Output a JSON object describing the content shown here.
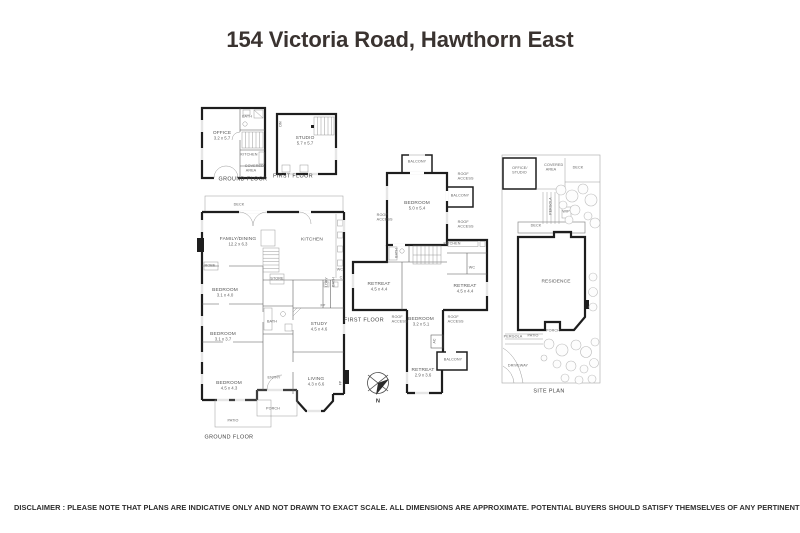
{
  "title": "154 Victoria Road, Hawthorn East",
  "disclaimer": "DISCLAIMER : PLEASE NOTE THAT PLANS ARE INDICATIVE ONLY AND NOT DRAWN TO EXACT SCALE. ALL DIMENSIONS ARE APPROXIMATE. POTENTIAL BUYERS SHOULD SATISFY THEMSELVES OF ANY PERTINENT MATTERS.",
  "compass": {
    "north_label": "N"
  },
  "plans": {
    "outbuilding_ground": {
      "floor_label": "GROUND FLOOR",
      "office": {
        "name": "OFFICE",
        "dims": "3.2 x 5.7"
      },
      "bath": "BATH",
      "kitchen": "KITCHEN",
      "covered_area": "COVERED AREA"
    },
    "outbuilding_first": {
      "floor_label": "FIRST FLOOR",
      "studio": {
        "name": "STUDIO",
        "dims": "5.7 x 5.7"
      },
      "dn": "DN"
    },
    "ground_floor": {
      "floor_label": "GROUND FLOOR",
      "deck": "DECK",
      "family_dining": {
        "name": "FAMILY/DINING",
        "dims": "12.2 x 6.3"
      },
      "kitchen": "KITCHEN",
      "bedroom1": {
        "name": "BEDROOM",
        "dims": "3.1 x 4.0"
      },
      "robe": "ROBE",
      "store": "STORE",
      "bath": "BATH",
      "study": {
        "name": "STUDY",
        "dims": "4.5 x 4.6"
      },
      "bedroom2": {
        "name": "BEDROOM",
        "dims": "3.1 x 3.7"
      },
      "bedroom3": {
        "name": "BEDROOM",
        "dims": "4.5 x 4.3"
      },
      "entry": "ENTRY",
      "living": {
        "name": "LIVING",
        "dims": "4.3 x 6.6"
      },
      "porch": "PORCH",
      "patio": "PATIO",
      "ldry": "LDRY",
      "bath2": "BATH",
      "wc": "WC",
      "cupboard": "C",
      "fp": "FP"
    },
    "first_floor": {
      "floor_label": "FIRST FLOOR",
      "balcony": "BALCONY",
      "roof_access": "ROOF ACCESS",
      "bedroom1": {
        "name": "BEDROOM",
        "dims": "5.0 x 5.4"
      },
      "kitchen": "KITCHEN",
      "bath": "BATH",
      "retreat1": {
        "name": "RETREAT",
        "dims": "4.5 x 4.4"
      },
      "retreat2": {
        "name": "RETREAT",
        "dims": "4.5 x 4.4"
      },
      "bedroom2": {
        "name": "BEDROOM",
        "dims": "3.2 x 5.1"
      },
      "retreat3": {
        "name": "RETREAT",
        "dims": "2.9 x 3.6"
      },
      "wc": "WC",
      "ac": "AC"
    },
    "site": {
      "plan_label": "SITE PLAN",
      "office_studio": "OFFICE/ STUDIO",
      "covered_area": "COVERED AREA",
      "deck_top": "DECK",
      "pergola_top": "PERGOLA",
      "wip": "WIP",
      "deck_band": "DECK",
      "residence": "RESIDENCE",
      "porch": "PORCH",
      "pergola_bottom": "PERGOLA",
      "patio": "PATIO",
      "driveway": "DRIVEWAY"
    }
  }
}
